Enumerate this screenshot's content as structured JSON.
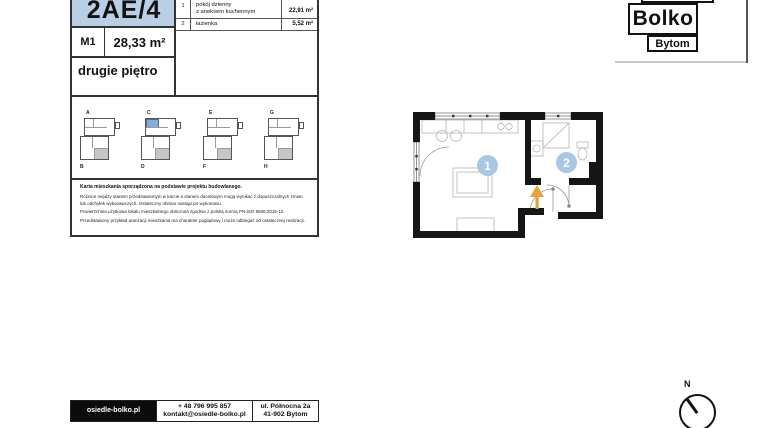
{
  "card": {
    "unit_number": "2AE/4",
    "unit_code": "M1",
    "total_area": "28,33 m²",
    "floor": "drugie piętro",
    "room_table": {
      "rows": [
        {
          "no": "1",
          "name_line1": "pokój dzienny",
          "name_line2": "z aneksem kuchennym",
          "area": "22,91 m²"
        },
        {
          "no": "2",
          "name_line1": "łazienka",
          "name_line2": "",
          "area": "5,52 m²"
        }
      ]
    },
    "thumbnails": [
      {
        "top_label": "A",
        "bottom_label": "B"
      },
      {
        "top_label": "C",
        "bottom_label": "D"
      },
      {
        "top_label": "E",
        "bottom_label": "F"
      },
      {
        "top_label": "G",
        "bottom_label": "H"
      }
    ],
    "disclaimer": {
      "title": "Karta mieszkania sporządzona na podstawie projektu budowlanego.",
      "line1": "Różnice między stanem przedstawionym w karcie a stanem docelowym mogą wynikać z dopuszczalnych zmian",
      "line2": "lub odchyłek wykonawczych. Ostateczny obmiar nastąpi po wykonaniu.",
      "line3": "Powierzchnia użytkowa lokalu mieszkalnego obliczona zgodnie z polską normą PN-ISO 9836:2015-12",
      "line4": "Przedstawiony przykład aranżacji mieszkania ma charakter poglądowy i może odbiegać od ostatecznej realizacji."
    }
  },
  "logo": {
    "brand": "Bolko",
    "city": "Bytom"
  },
  "floor_plan": {
    "badge1": "1",
    "badge2": "2"
  },
  "footer": {
    "website": "osiedle-bolko.pl",
    "phone": "+ 48 796 995 857",
    "email": "kontakt@osiedle-bolko.pl",
    "address_line1": "ul. Północna 2a",
    "address_line2": "41-902 Bytom"
  },
  "compass": {
    "label": "N"
  },
  "colors": {
    "header_blue": "#b9cfe5",
    "badge_blue": "#a9c6e3",
    "highlight_blue": "#85aed3",
    "wall_black": "#161616",
    "arrow_orange": "#e5a33d",
    "shade_gray": "#c6c6c6"
  }
}
